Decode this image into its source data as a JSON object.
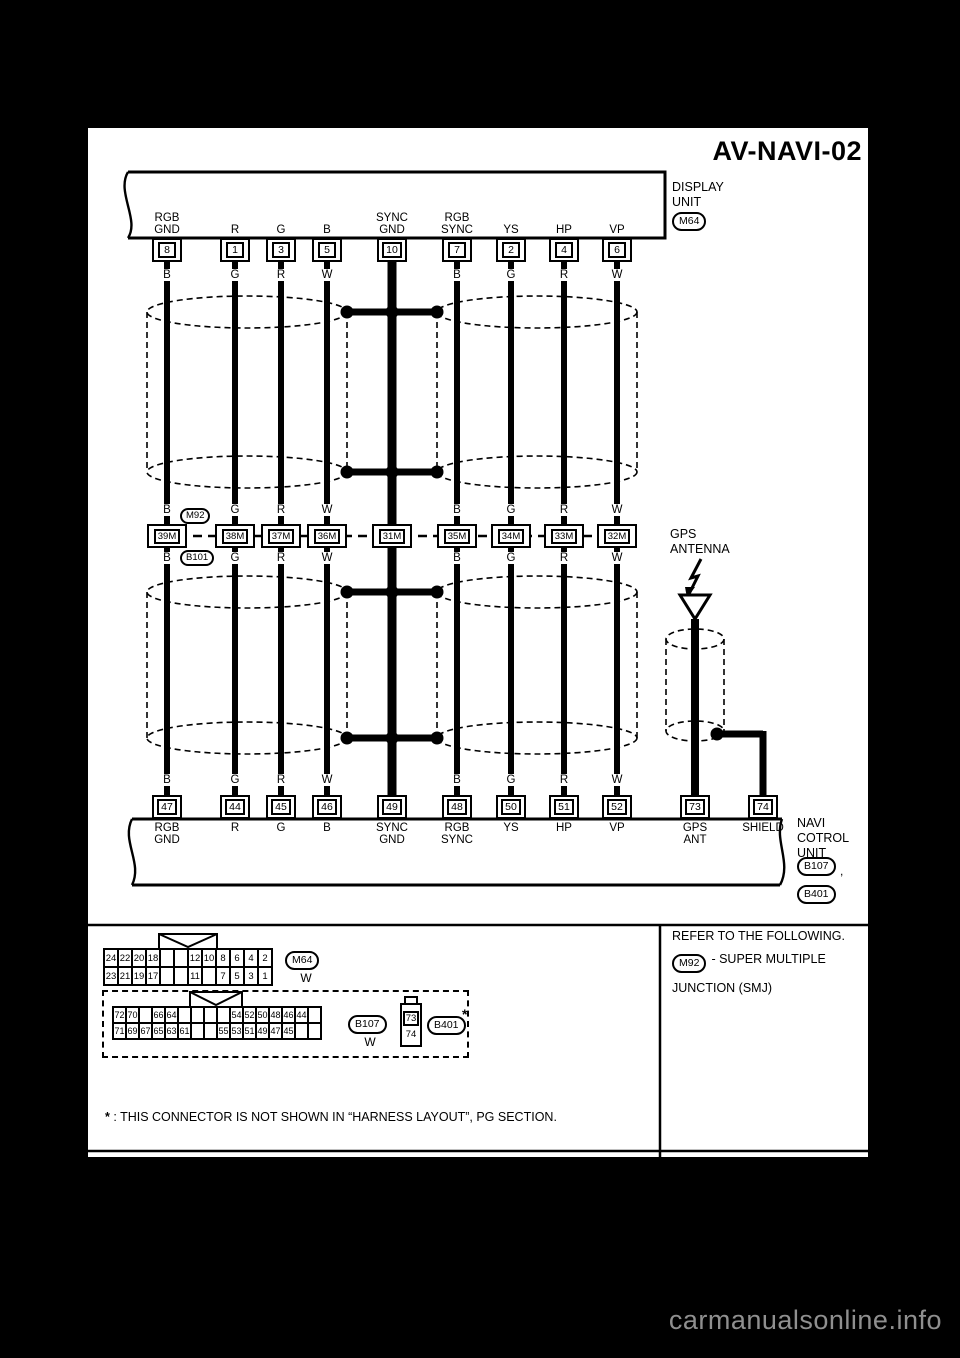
{
  "title": "AV-NAVI-02",
  "watermark": "carmanualsonline.info",
  "display_unit": {
    "name_lines": [
      "DISPLAY",
      "UNIT"
    ],
    "connector": "M64"
  },
  "navi_unit": {
    "name_lines": [
      "NAVI",
      "COTROL",
      "UNIT"
    ],
    "connector1": "B107",
    "comma": ",",
    "connector2": "B401"
  },
  "gps_antenna": {
    "label_lines": [
      "GPS",
      "ANTENNA"
    ]
  },
  "smj_ovals": {
    "above": "M92",
    "below": "B101"
  },
  "columns": [
    {
      "top_pin": "8",
      "top_label": "RGB GND",
      "wire_color": "B",
      "mid_connector": "39M",
      "bottom_pin": "47",
      "bottom_label": "RGB GND"
    },
    {
      "top_pin": "1",
      "top_label": "R",
      "wire_color": "G",
      "mid_connector": "38M",
      "bottom_pin": "44",
      "bottom_label": "R"
    },
    {
      "top_pin": "3",
      "top_label": "G",
      "wire_color": "R",
      "mid_connector": "37M",
      "bottom_pin": "45",
      "bottom_label": "G"
    },
    {
      "top_pin": "5",
      "top_label": "B",
      "wire_color": "W",
      "mid_connector": "36M",
      "bottom_pin": "46",
      "bottom_label": "B"
    },
    {
      "top_pin": "10",
      "top_label": "SYNC GND",
      "wire_color": "",
      "mid_connector": "31M",
      "bottom_pin": "49",
      "bottom_label": "SYNC GND"
    },
    {
      "top_pin": "7",
      "top_label": "RGB SYNC",
      "wire_color": "B",
      "mid_connector": "35M",
      "bottom_pin": "48",
      "bottom_label": "RGB SYNC"
    },
    {
      "top_pin": "2",
      "top_label": "YS",
      "wire_color": "G",
      "mid_connector": "34M",
      "bottom_pin": "50",
      "bottom_label": "YS"
    },
    {
      "top_pin": "4",
      "top_label": "HP",
      "wire_color": "R",
      "mid_connector": "33M",
      "bottom_pin": "51",
      "bottom_label": "HP"
    },
    {
      "top_pin": "6",
      "top_label": "VP",
      "wire_color": "W",
      "mid_connector": "32M",
      "bottom_pin": "52",
      "bottom_label": "VP"
    }
  ],
  "gps_column": {
    "bottom_pin": "73",
    "bottom_label": "GPS ANT"
  },
  "shield_column": {
    "bottom_pin": "74",
    "bottom_label": "SHIELD"
  },
  "connector_views": {
    "m64": {
      "id": "M64",
      "color": "W",
      "rows": [
        [
          "24",
          "22",
          "20",
          "18",
          "",
          "",
          "12",
          "10",
          "8",
          "6",
          "4",
          "2"
        ],
        [
          "23",
          "21",
          "19",
          "17",
          "",
          "",
          "11",
          "",
          "7",
          "5",
          "3",
          "1"
        ]
      ]
    },
    "b107": {
      "id": "B107",
      "color": "W",
      "rows": [
        [
          "72",
          "70",
          "",
          "66",
          "64",
          "",
          "",
          "",
          "",
          "54",
          "52",
          "50",
          "48",
          "46",
          "44",
          ""
        ],
        [
          "71",
          "69",
          "67",
          "65",
          "63",
          "61",
          "",
          "",
          "55",
          "53",
          "51",
          "49",
          "47",
          "45",
          "",
          ""
        ]
      ]
    },
    "b401": {
      "id": "B401",
      "star": "*",
      "pin_top": "73",
      "pin_bottom": "74"
    }
  },
  "refer_panel": {
    "line1": "REFER TO THE FOLLOWING.",
    "oval": "M92",
    "line2": "- SUPER MULTIPLE",
    "line3": "JUNCTION (SMJ)"
  },
  "footnote": {
    "star": "*",
    "text": " : THIS CONNECTOR IS NOT SHOWN IN “HARNESS LAYOUT”, PG SECTION."
  }
}
